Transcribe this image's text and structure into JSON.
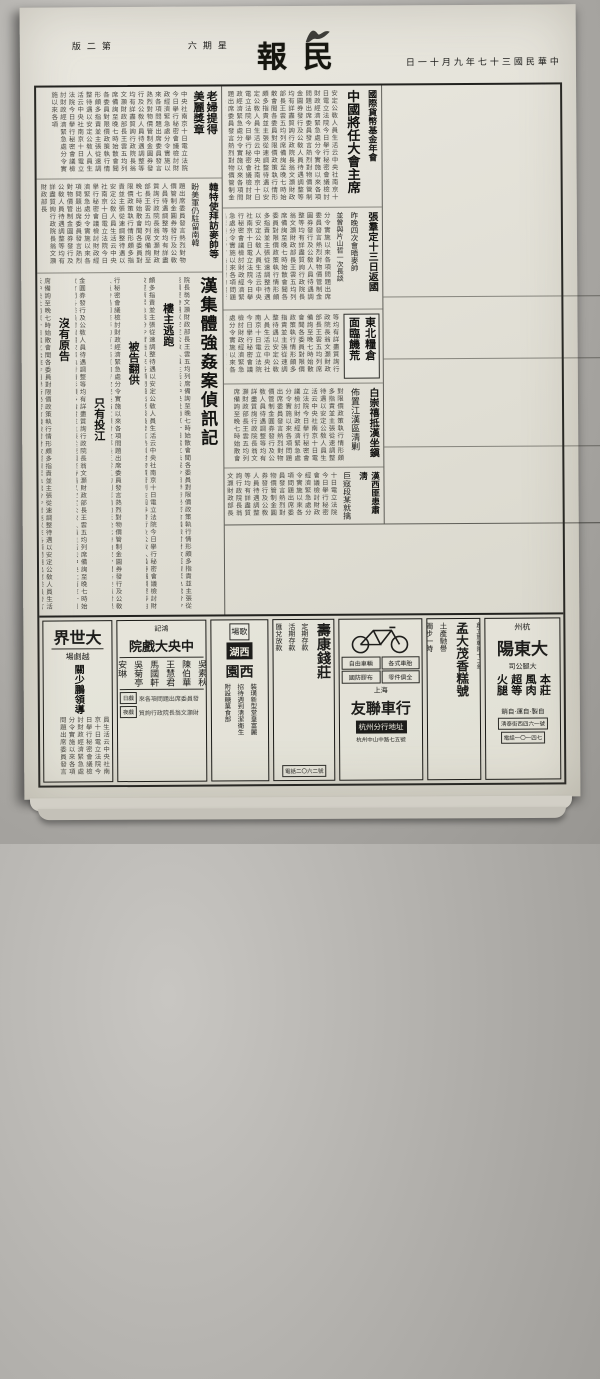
{
  "filler": "中央社南京十日電立法院今日擧行秘密會議檢討財政經濟緊急處分令實施以來各項問題出席委員發言熱烈對物價管制金圓券發行及公敎人員待遇調整等均有詳盡質詢行政院長翁文灝財政部長王雲五均列席備詢至晚七時始散會聞各委員對限價政策執行情形頗多指責並主張從速調整待遇以安定公敎人員生活云",
  "page": {
    "edition": "第二版",
    "weekday": "星期六",
    "masthead": "民報",
    "date": "中華民國三十七年九月十一日"
  },
  "lead": {
    "kicker": "立院昨整日秘密會議",
    "headline": "檢討財經緊急措施",
    "sub1": "強調控制物價導游資入正軌",
    "sub2": "主張合理調整公敎人員待遇",
    "sub3": "立委紛提質詢指責擅增鹽稅"
  },
  "articles": {
    "imf": {
      "kicker": "國際貨幣基金年會",
      "headline": "中國將任大會主席"
    },
    "oldlady": {
      "headline": "老婦提得美麗獎章"
    },
    "korea": {
      "headline": "韓特使拜訪麥帥等",
      "sub": "盼美軍仍駐留南韓"
    },
    "rape": {
      "headline": "漢集體強姦案偵訊記",
      "subheads": [
        "樓主逃跑",
        "被告翻供",
        "只有投江",
        "沒有原告"
      ]
    },
    "zhangqun": {
      "headline": "張羣定十三日返國",
      "sub1": "昨晚四次會晤麥帥",
      "sub2": "並曾與片山哲一次長談"
    },
    "northeast": {
      "line1": "東北糧倉",
      "line2": "面臨饑荒"
    },
    "bai": {
      "headline": "白崇禧抵漢坐鎭",
      "sub": "佈置江漢區淸剿"
    },
    "hankou": {
      "headline": "漢西匪患肅淸",
      "sub": "巨寇段某就擒"
    },
    "wang": {
      "l1": "王外長",
      "l2": "十七日首途"
    },
    "stocks": {
      "headline": "五公司股票昨上市",
      "sub": "一日共成交金圓百廿餘萬",
      "sub2": "靑島中紡今天起改組"
    },
    "governor": {
      "headline": "港督抵滬"
    },
    "traitor": {
      "headline": "巨奸伏法",
      "sub1": "王逆揖唐兩彈斃命",
      "sub2": "臨死尚請總統開恩"
    },
    "tao": {
      "headline": "陶案調查完竣",
      "headline2": "兩監委草報告",
      "sub1": "認爲王雲五不無責任",
      "sub2": "若干監委擬提出彈劾"
    },
    "berlin": {
      "headline": "柏林危機日益加劇",
      "headline2": "三國會商應付方案",
      "sub": "美不擬受蘇脅迫下談判"
    }
  },
  "ads": {
    "dashijie": {
      "name": "大世界",
      "tag": "越劇場",
      "line": "關少鵬領導"
    },
    "zhongyang": {
      "tag": "鴻記",
      "name": "中央大戲院",
      "performers": [
        "吳素秋",
        "陳伯華",
        "王慧君",
        "馬國軒",
        "吳菊亭",
        "安琳"
      ],
      "row1": "日戲",
      "row2": "夜戲"
    },
    "xihu": {
      "box1": "歌場",
      "box2": "西湖",
      "name": "西園",
      "lines": [
        "裝璜新型堂皇富麗",
        "招待週到淸潔衛生",
        "附設糖菓食部"
      ]
    },
    "shoukang": {
      "name": "壽康錢莊",
      "services": [
        "定期存款",
        "活期存款",
        "匯兌放款"
      ],
      "phone": "電話二〇六二號"
    },
    "youlian": {
      "city": "上海",
      "name": "友聯車行",
      "items": [
        "自由車輛",
        "各式車胎",
        "國防膠布",
        "零件俱全"
      ],
      "branch": "杭州分行地址",
      "addr": "杭州中山中路七五號"
    },
    "mengdamao": {
      "est": "創立於乾隆十二年",
      "name": "孟大茂香糕號",
      "line1": "土產馳譽",
      "line2": "獨步一時"
    },
    "dadongyang": {
      "city": "杭州",
      "name": "大東陽",
      "tag": "大腿公司",
      "products": "本莊風肉超等火腿",
      "line": "自製·自運·自銷",
      "addr": "淸泰街西四六一號",
      "phone": "電話一〇一四七"
    }
  }
}
